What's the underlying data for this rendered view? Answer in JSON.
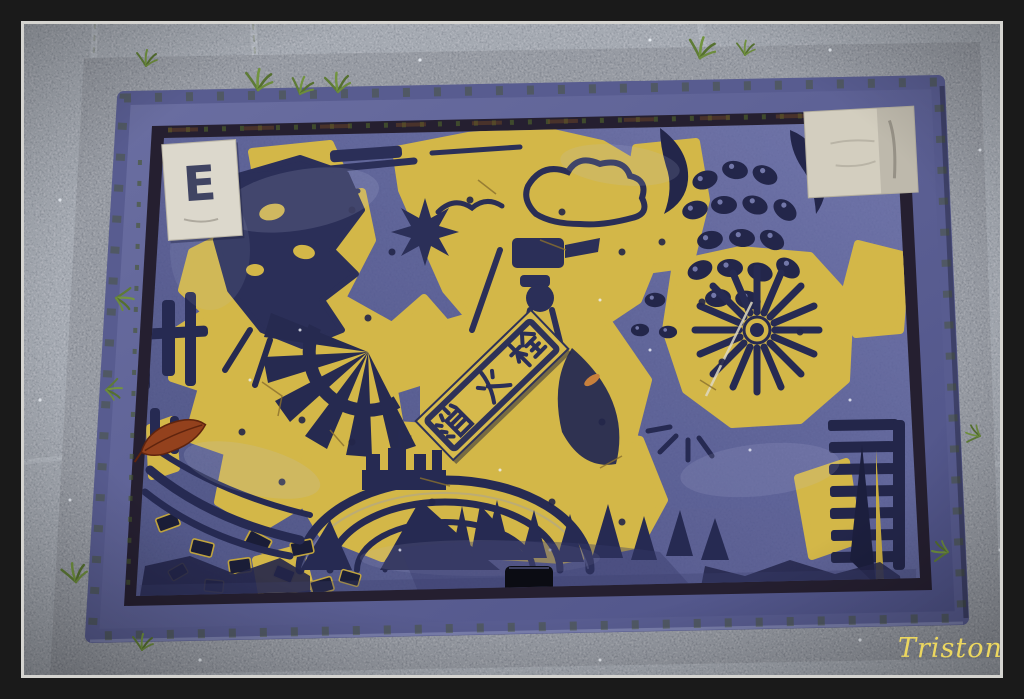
{
  "image": {
    "width_px": 1024,
    "height_px": 699,
    "kind": "photograph",
    "subject": "Blue and yellow Japanese fire hydrant access cover set in gravel paving"
  },
  "frame": {
    "matte_color": "#1a1a1a",
    "border_line_color": "#d5d4d0"
  },
  "watermark": {
    "text": "Triston",
    "color": "#ecd75f"
  },
  "cover": {
    "plaque": {
      "text": "消火栓",
      "char_top": "栓",
      "char_middle": "火",
      "char_bottom": "消",
      "panel_color": "#d6ba4c",
      "glyph_color": "#2a2e58"
    },
    "sticker_top_left": {
      "label": "E",
      "color": "#dcd8cc"
    },
    "sticker_top_right": {
      "label": "",
      "color": "#d3cebf"
    },
    "key_slot_color": "#0b0c13",
    "colors": {
      "plate": "#575c94",
      "relief": "#2b2f58",
      "paint_yellow": "#d3b748",
      "rim": "#5e6295",
      "groove": "#251f30"
    }
  },
  "pavement": {
    "gravel_color": "#80848d",
    "collar_color": "#63676f",
    "moss_color": "#55682f"
  },
  "extras": {
    "leaf_color": "#93411d"
  }
}
